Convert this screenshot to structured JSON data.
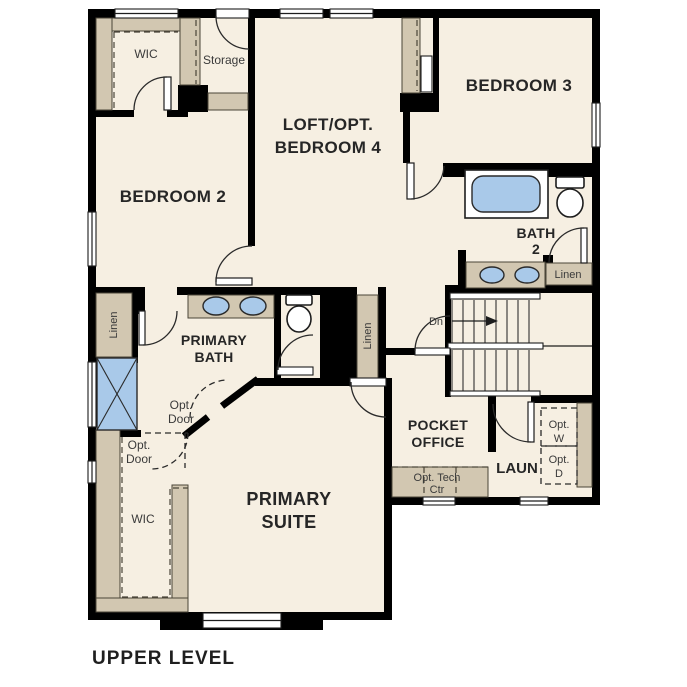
{
  "title": "UPPER LEVEL",
  "colors": {
    "floor": "#f6efe2",
    "cabinet": "#d2c7b1",
    "fixture_blue": "#a9c9e9",
    "appliance_gray": "#dfe5e9",
    "wall": "#000000"
  },
  "rooms": {
    "wic_upper": {
      "label": "WIC"
    },
    "storage": {
      "label": "Storage"
    },
    "loft": {
      "line1": "LOFT/OPT.",
      "line2": "BEDROOM 4"
    },
    "bedroom2": {
      "label": "BEDROOM 2"
    },
    "bedroom3": {
      "label": "BEDROOM 3"
    },
    "bath2": {
      "line1": "BATH",
      "line2": "2"
    },
    "bath2_linen": {
      "label": "Linen"
    },
    "stairs": {
      "down_label": "Dn"
    },
    "linen_left": {
      "label": "Linen"
    },
    "linen_mid": {
      "label": "Linen"
    },
    "primary_bath": {
      "line1": "PRIMARY",
      "line2": "BATH"
    },
    "opt_door_upper": {
      "line1": "Opt.",
      "line2": "Door"
    },
    "opt_door_lower": {
      "line1": "Opt.",
      "line2": "Door"
    },
    "wic_lower": {
      "label": "WIC"
    },
    "primary_suite": {
      "line1": "PRIMARY",
      "line2": "SUITE"
    },
    "pocket_office": {
      "line1": "POCKET",
      "line2": "OFFICE"
    },
    "tech_center": {
      "line1": "Opt. Tech",
      "line2": "Ctr"
    },
    "laundry": {
      "label": "LAUN"
    },
    "opt_washer": {
      "line1": "Opt.",
      "line2": "W"
    },
    "opt_dryer": {
      "line1": "Opt.",
      "line2": "D"
    }
  }
}
